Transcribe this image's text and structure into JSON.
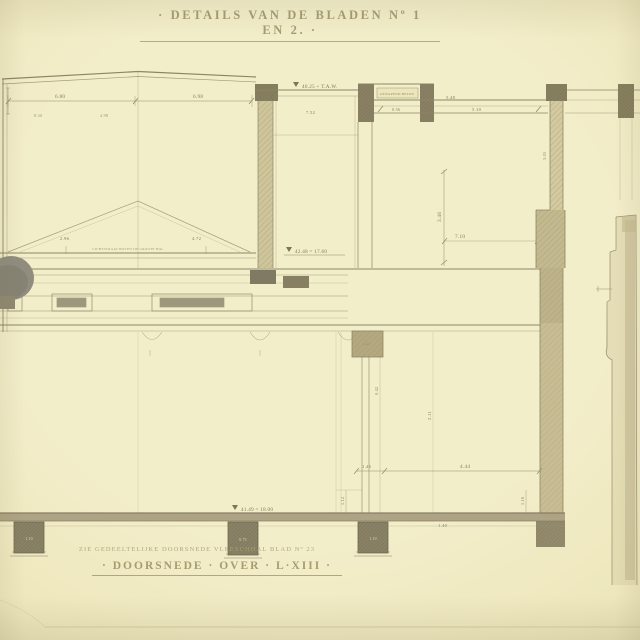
{
  "drawing": {
    "title": "· DETAILS VAN DE BLADEN Nº 1 EN 2. ·",
    "footer_note": "ZIE GEDEELTELIJKE DOORSNEDE VLEESCHHAL BLAD Nº 23",
    "footer_title": "· DOORSNEDE · OVER · L·XIII ·"
  },
  "levels": {
    "top": "40.25 + T.A.W.",
    "mid": "42.48 = 17.60",
    "ground": "41.49 = 18.00"
  },
  "dims": {
    "roof_left": "6.80",
    "roof_right": "6.98",
    "hall_small_a": "8.30",
    "hall_small_b": "4.98",
    "gable_left": "2.96",
    "gable_right": "4.72",
    "skylight_note": "LICHTSTRAAT BOVEN DE GROOTE HAL",
    "top_room_width": "7.52",
    "lantern_note": "GEWAPEND BETON",
    "attic_width": "5.48",
    "floor_small": "0.56",
    "floor_right": "5.10",
    "room_height": "3.46",
    "room_width": "7.10",
    "wall_height": "3.05",
    "capital_dim": "0.45",
    "column_dim": "0.42",
    "axis_dim": "2.11",
    "base_left": "1.45",
    "base_mid": "4.44",
    "base_small": "1.40",
    "pier_left_dim": "1.10",
    "pier_mid_dim": "0.75",
    "pier_right_dim": "1.10",
    "vdim_left": "1.12",
    "vdim_right": "1.16"
  },
  "colors": {
    "paper": "#f2edc8",
    "ink": "#8f8769",
    "ink_dark": "#6f684f",
    "wall_fill": "#cfc59a",
    "block_dark": "#857e62",
    "ground": "#aca183"
  }
}
